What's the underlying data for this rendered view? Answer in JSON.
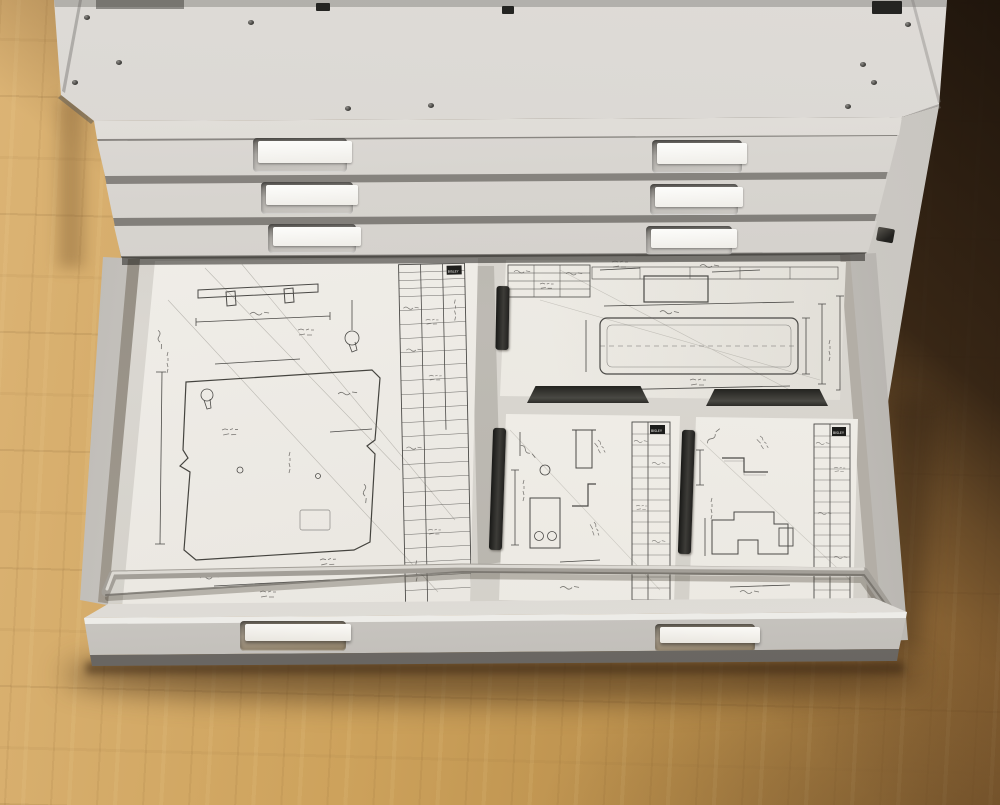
{
  "meta": {
    "type": "photograph",
    "subject": "Steel flat-file plan cabinet with open drawer of engineering blueprints, standing on a wooden floor",
    "view": "elevated three-quarter view from the front"
  },
  "brand_label": "BISLEY",
  "cabinet": {
    "material": "light grey painted steel",
    "closed_drawer_rows": 3,
    "label_holders_per_row": 2,
    "open_drawers": 1,
    "features": [
      "beveled top corners",
      "vent slots on top",
      "screw heads on top",
      "lock plate on right side"
    ]
  },
  "open_drawer": {
    "handles": 2,
    "contents": {
      "sheets": 4,
      "sheet_layout": [
        "large sheet left",
        "wide sheet top right",
        "small sheet bottom center",
        "small sheet bottom right"
      ],
      "sheet_content": "pencil technical drawings with dimension lines and handwritten title blocks (entries illegible)",
      "black_retainer_clips": 5,
      "metal_holddown_bar": 1
    }
  },
  "floor": {
    "description": "light oak parquet, falling into deep shadow at top right, drawer casts shadow below"
  },
  "palette": {
    "cabinet_light": "#d7d4cf",
    "cabinet_shadowed": "#b2afaa",
    "drawer_gap": "#5c5955",
    "paper": "#f1efe9",
    "linework": "#4b4a47",
    "clip_black": "#23231f",
    "floor_light": "#cda25c",
    "floor_dark": "#2a1c11",
    "card_white": "#fdfdfb"
  }
}
